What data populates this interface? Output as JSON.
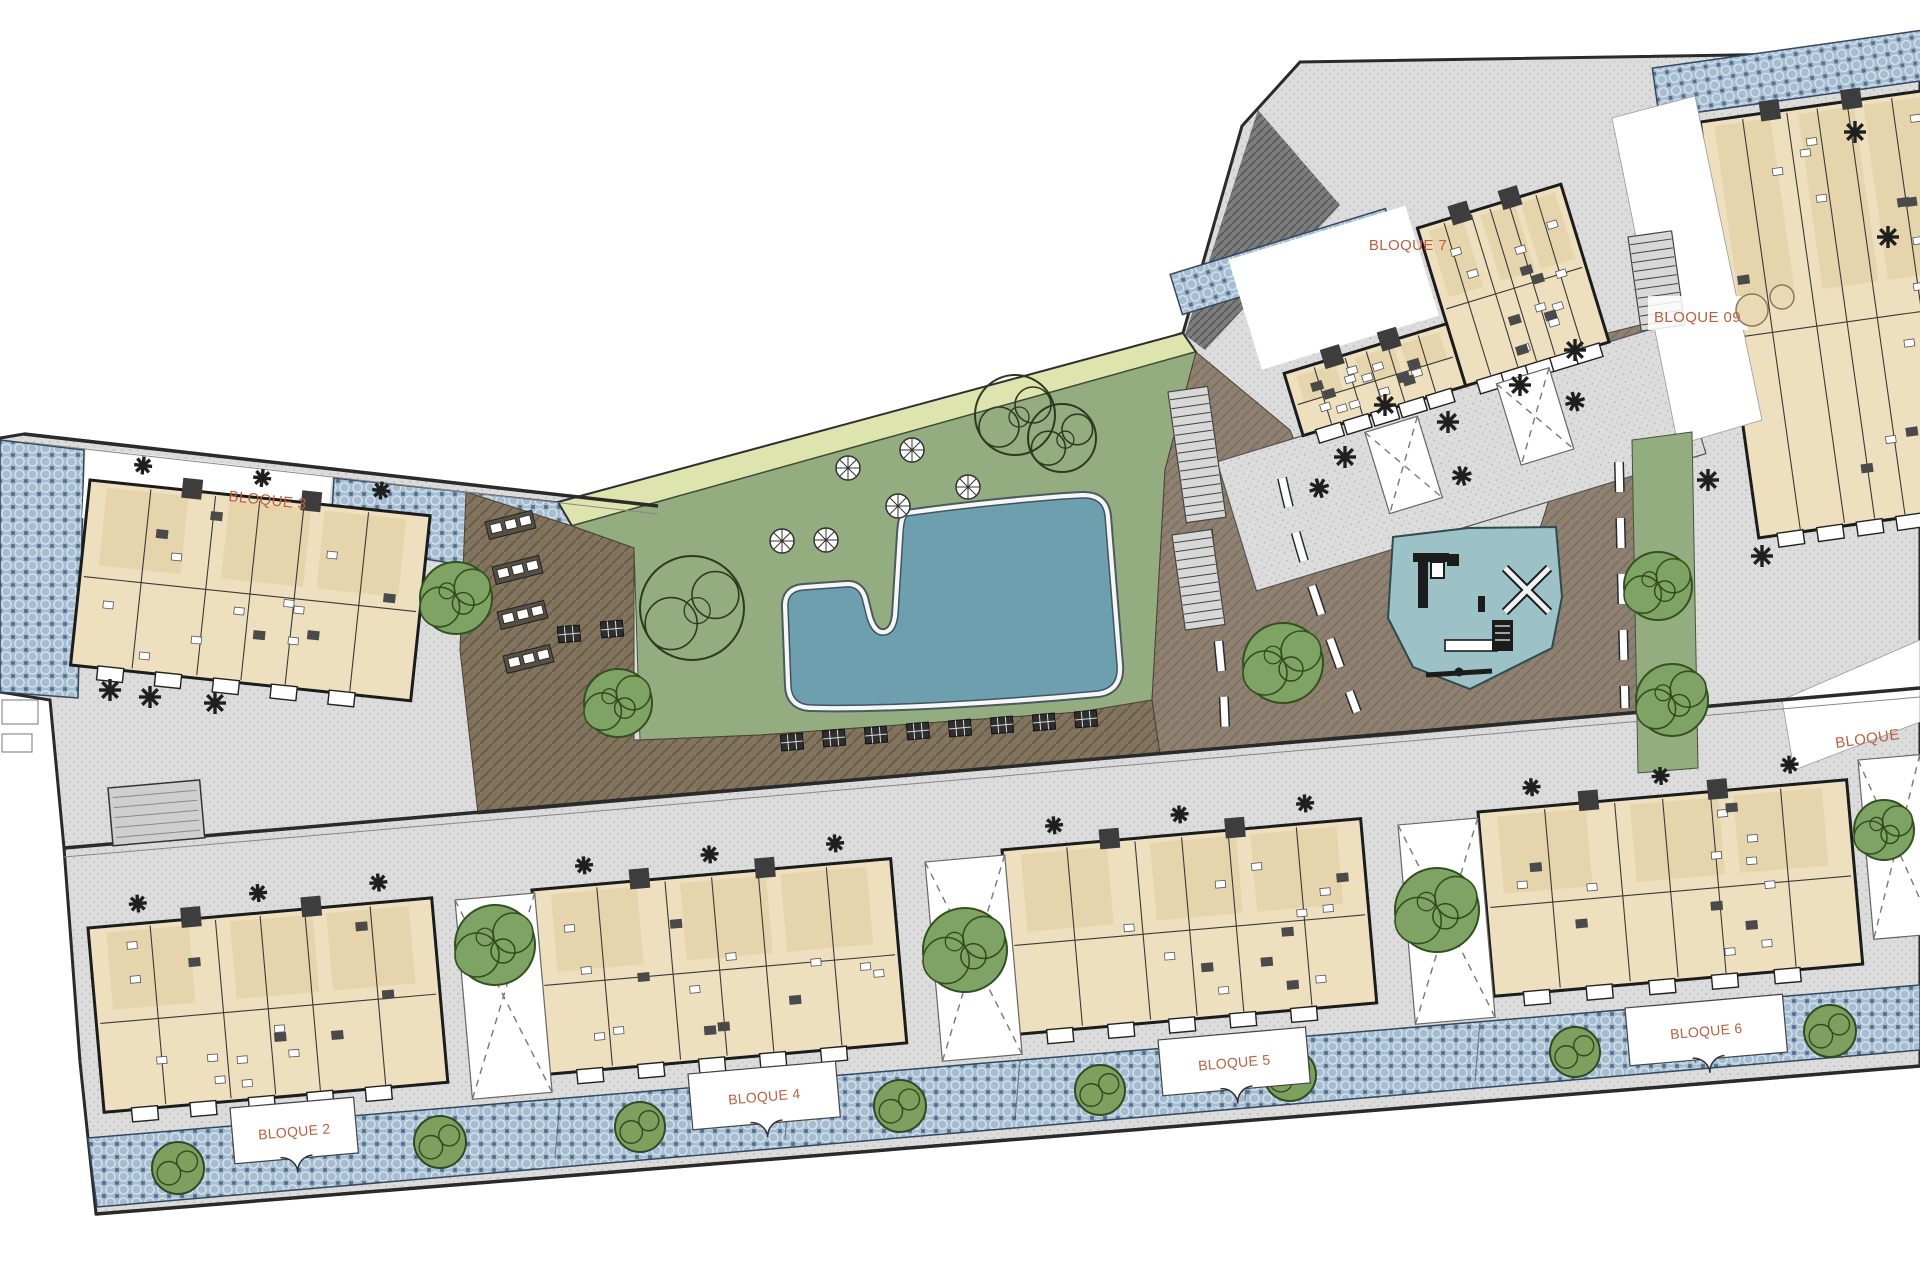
{
  "plan": {
    "title": "Residential complex site plan",
    "blocks": {
      "block2": {
        "label": "BLOQUE 2"
      },
      "block3": {
        "label": "BLOQUE 3"
      },
      "block4": {
        "label": "BLOQUE 4"
      },
      "block5": {
        "label": "BLOQUE 5"
      },
      "block6": {
        "label": "BLOQUE 6"
      },
      "block7": {
        "label": "BLOQUE 7"
      },
      "block9": {
        "label": "BLOQUE 09"
      },
      "block8_partial": {
        "label": "BLOQUE"
      }
    },
    "colors": {
      "label_text": "#b9603f",
      "paving_gray": "#dcdcdc",
      "paving_blue_tile": "#a6bdd1",
      "deck_brown": "#84755f",
      "plaza_brown": "#8f8071",
      "lawn_green": "#93ac80",
      "planting_band": "#dde4ad",
      "pool_water": "#6d9fae",
      "playground_surface": "#9cc2c8",
      "tree_green": "#7fa265",
      "building_fill": "#eedfbf",
      "building_wall": "#1c1c1c"
    },
    "features": {
      "pool": "swimming-pool",
      "playground": "children-playground",
      "lawn": "lawn-garden",
      "deck": "timber-sun-deck",
      "road": "internal-driveway",
      "tile_paving": "decorative-tile-paving",
      "concrete_paving": "concrete-paving"
    }
  }
}
